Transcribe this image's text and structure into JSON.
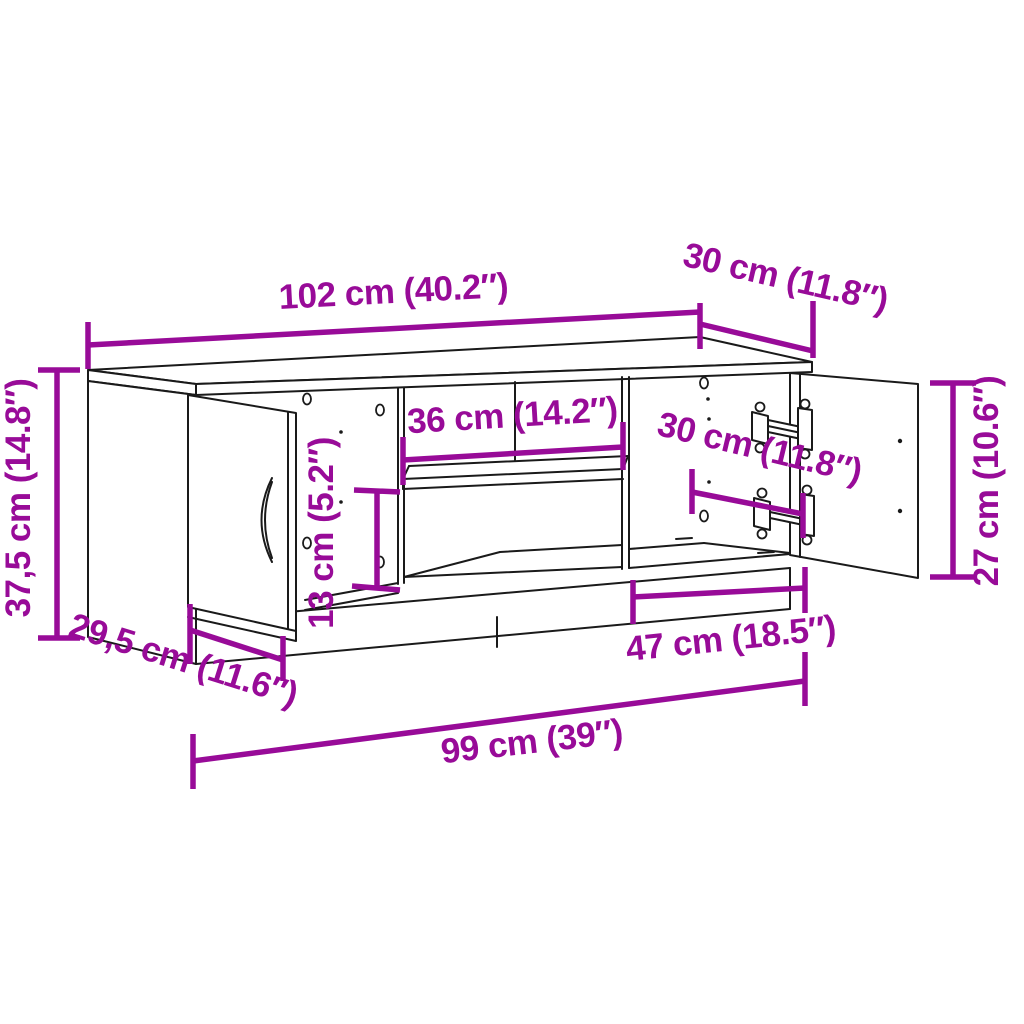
{
  "diagram": {
    "type": "furniture-dimension-diagram",
    "product": "TV cabinet with side doors and open middle shelves",
    "colors": {
      "dimension": "#980B98",
      "line": "#1A1A1A",
      "background": "#FFFFFF"
    },
    "dimensions": [
      {
        "id": "top-width",
        "label": "102 cm (40.2″)"
      },
      {
        "id": "top-depth",
        "label": "30 cm (11.8″)"
      },
      {
        "id": "left-height",
        "label": "37,5 cm (14.8″)"
      },
      {
        "id": "shelf-width",
        "label": "36 cm (14.2″)"
      },
      {
        "id": "lower-shelf-height",
        "label": "13 cm (5.2″)"
      },
      {
        "id": "right-door-width",
        "label": "30 cm (11.8″)"
      },
      {
        "id": "right-door-height",
        "label": "27 cm (10.6″)"
      },
      {
        "id": "bottom-depth",
        "label": "29,5 cm (11.6″)"
      },
      {
        "id": "right-section-width",
        "label": "47 cm (18.5″)"
      },
      {
        "id": "bottom-width",
        "label": "99 cm (39″)"
      }
    ]
  }
}
